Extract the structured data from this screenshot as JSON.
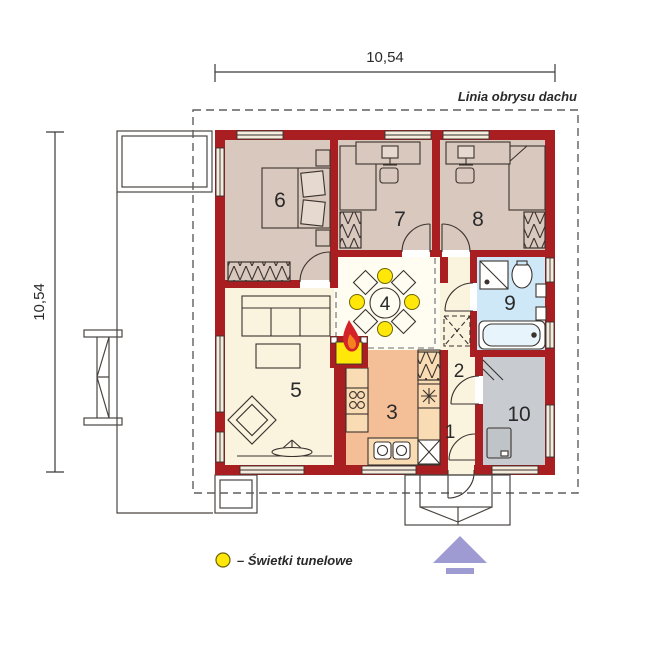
{
  "plan": {
    "dimensions": {
      "top": "10,54",
      "left": "10,54"
    },
    "roof_outline_label": "Linia obrysu dachu",
    "legend": {
      "symbol": "skylight-circle",
      "label": "– Świetki tunelowe"
    },
    "rooms": [
      {
        "number": "1",
        "type": "entrance-hall"
      },
      {
        "number": "2",
        "type": "corridor"
      },
      {
        "number": "3",
        "type": "kitchen"
      },
      {
        "number": "4",
        "type": "dining"
      },
      {
        "number": "5",
        "type": "living-room"
      },
      {
        "number": "6",
        "type": "bedroom"
      },
      {
        "number": "7",
        "type": "bedroom"
      },
      {
        "number": "8",
        "type": "bedroom"
      },
      {
        "number": "9",
        "type": "bathroom"
      },
      {
        "number": "10",
        "type": "utility-room"
      }
    ],
    "colors": {
      "wall": "#a81e21",
      "bedroom_floor": "#d9c8bd",
      "living_floor": "#faf3de",
      "dining_floor": "#fffdf2",
      "kitchen_floor": "#f4bf97",
      "kitchen_counter": "#f9dcb4",
      "bathroom_floor": "#cfe8f8",
      "utility_floor": "#c8ccd1",
      "skylight_yellow": "#ffe70a",
      "north_arrow": "#9e9ad2",
      "flame": "#d42328"
    }
  }
}
